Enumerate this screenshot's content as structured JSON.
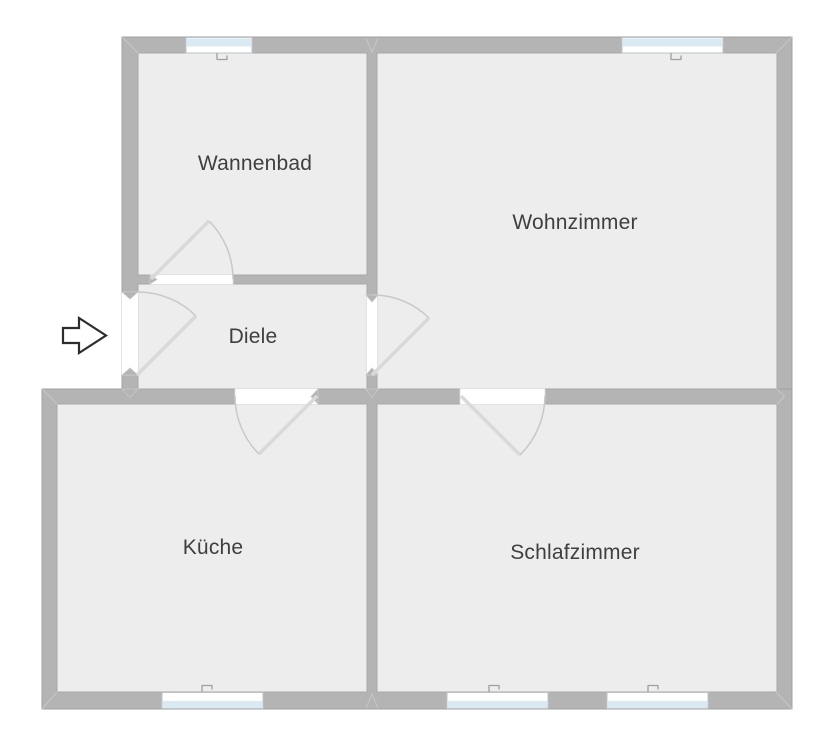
{
  "diagram_type": "floor-plan",
  "rooms": [
    {
      "name": "Wannenbad",
      "windows": 1
    },
    {
      "name": "Wohnzimmer",
      "windows": 1
    },
    {
      "name": "Diele",
      "windows": 0
    },
    {
      "name": "Küche",
      "windows": 1
    },
    {
      "name": "Schlafzimmer",
      "windows": 2
    }
  ],
  "doors": [
    {
      "from": "Außen",
      "to": "Diele",
      "type": "entrance"
    },
    {
      "from": "Diele",
      "to": "Wannenbad",
      "type": "interior"
    },
    {
      "from": "Diele",
      "to": "Wohnzimmer",
      "type": "interior"
    },
    {
      "from": "Diele",
      "to": "Küche",
      "type": "interior"
    },
    {
      "from": "Wohnzimmer",
      "to": "Schlafzimmer",
      "type": "interior"
    }
  ],
  "entrance_symbol": "arrow-right",
  "colors": {
    "background": "#ffffff",
    "wall": "#b4b4b4",
    "wall_outline": "#a0a0a0",
    "floor": "#ededee",
    "window_glass": "#d9eaf2",
    "window_frame": "#bcc3c7",
    "door_swing": "#c8c8c8",
    "door_leaf": "#d9d9d9",
    "label_text": "#3f3f3f",
    "arrow_outline": "#2d2d2d"
  }
}
